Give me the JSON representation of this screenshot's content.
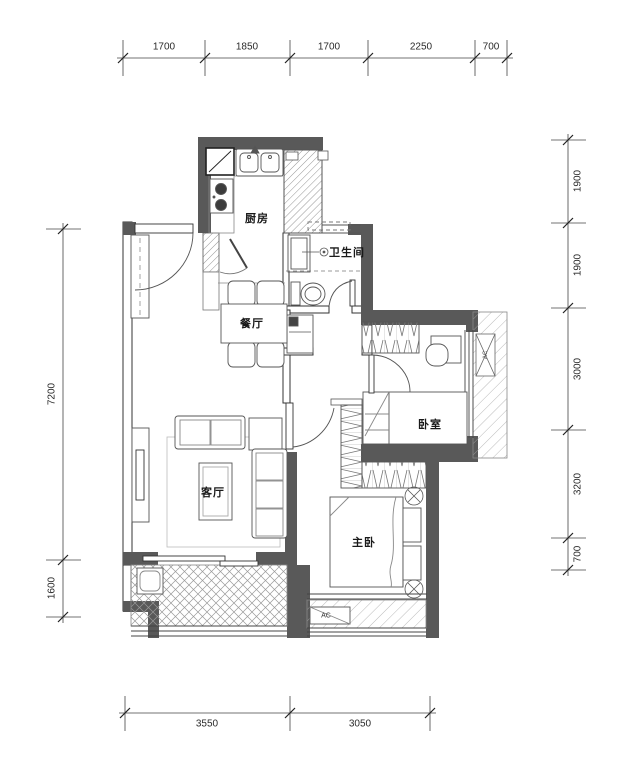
{
  "plan": {
    "type": "apartment-floor-plan",
    "wall_color": "#595959",
    "line_color": "#444444",
    "hatch_color": "#999999",
    "text_color": "#1a1a1a"
  },
  "rooms": {
    "kitchen": "厨房",
    "bathroom": "卫生间",
    "dining": "餐厅",
    "living": "客厅",
    "bedroom": "卧室",
    "master": "主卧"
  },
  "equipment": {
    "ac_bottom": "AC",
    "ac_side": "AC"
  },
  "dimensions": {
    "top": [
      "1700",
      "1850",
      "1700",
      "2250",
      "700"
    ],
    "bottom": [
      "3550",
      "3050"
    ],
    "right": [
      "1900",
      "1900",
      "3000",
      "3200",
      "700"
    ],
    "left": [
      "7200",
      "1600"
    ]
  }
}
